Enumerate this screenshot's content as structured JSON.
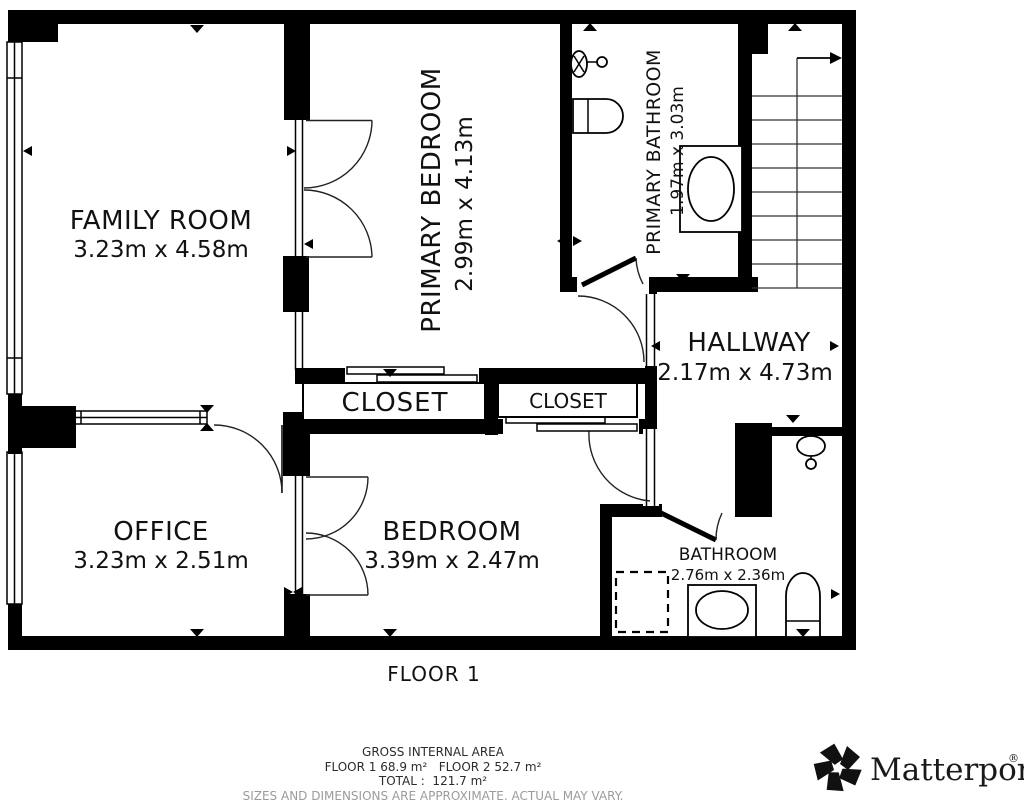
{
  "rooms": {
    "family_room": {
      "name": "FAMILY ROOM",
      "dims": "3.23m x 4.58m"
    },
    "primary_bedroom": {
      "name": "PRIMARY BEDROOM",
      "dims": "2.99m x 4.13m"
    },
    "primary_bathroom": {
      "name": "PRIMARY BATHROOM",
      "dims": "1.97m x 3.03m"
    },
    "hallway": {
      "name": "HALLWAY",
      "dims": "2.17m x 4.73m"
    },
    "closet_left": {
      "name": "CLOSET"
    },
    "closet_right": {
      "name": "CLOSET"
    },
    "office": {
      "name": "OFFICE",
      "dims": "3.23m x 2.51m"
    },
    "bedroom": {
      "name": "BEDROOM",
      "dims": "3.39m x 2.47m"
    },
    "bathroom": {
      "name": "BATHROOM",
      "dims": "2.76m x 2.36m"
    }
  },
  "floor_label": "FLOOR 1",
  "summary": {
    "title": "GROSS INTERNAL AREA",
    "areas_line": "FLOOR 1 68.9 m²   FLOOR 2 52.7 m²",
    "total_line": "TOTAL :  121.7 m²",
    "disclaimer": "SIZES AND DIMENSIONS ARE APPROXIMATE, ACTUAL MAY VARY."
  },
  "branding": {
    "logo_text": "Matterport",
    "registered_mark": "®"
  },
  "colors": {
    "wall": "#000000",
    "background": "#ffffff",
    "disclaimer_text": "#9b9b9b"
  }
}
